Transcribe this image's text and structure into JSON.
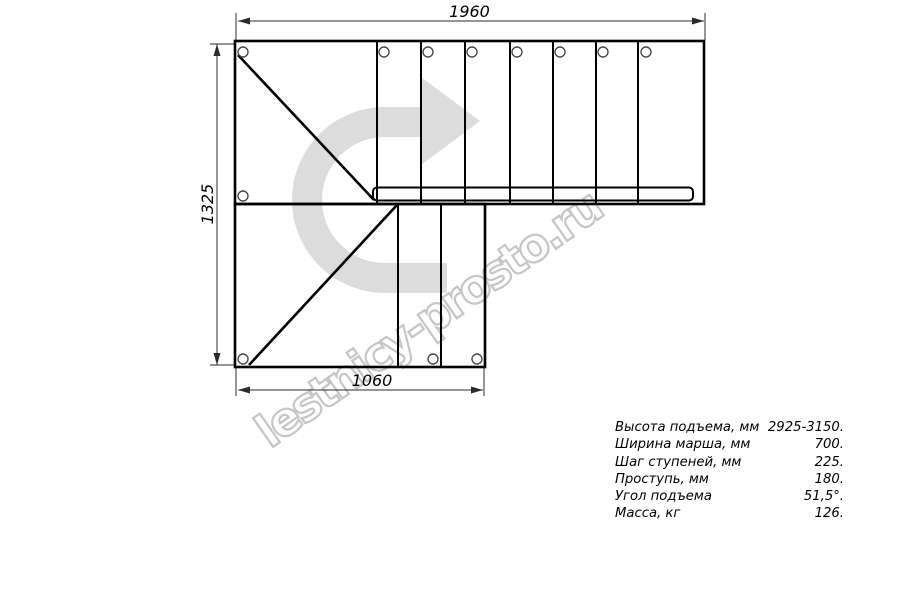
{
  "watermark": {
    "text": "lestnicy-prosto.ru",
    "outline_color": "#c6c6c6",
    "arrow_color": "#dcdcdc"
  },
  "dimensions": {
    "top_width_mm": "1960",
    "left_height_mm": "1325",
    "bottom_width_mm": "1060"
  },
  "specs": {
    "rows": [
      {
        "label": "Высота подъема, мм",
        "value": "2925-3150."
      },
      {
        "label": "Ширина марша, мм",
        "value": "700."
      },
      {
        "label": "Шаг ступеней, мм",
        "value": "225."
      },
      {
        "label": "Проступь, мм",
        "value": "180."
      },
      {
        "label": "Угол подъема",
        "value": "51,5°."
      },
      {
        "label": "Масса, кг",
        "value": "126."
      }
    ]
  },
  "colors": {
    "line": "#000000",
    "dimension_line": "#2b2b2b",
    "background": "#ffffff"
  }
}
